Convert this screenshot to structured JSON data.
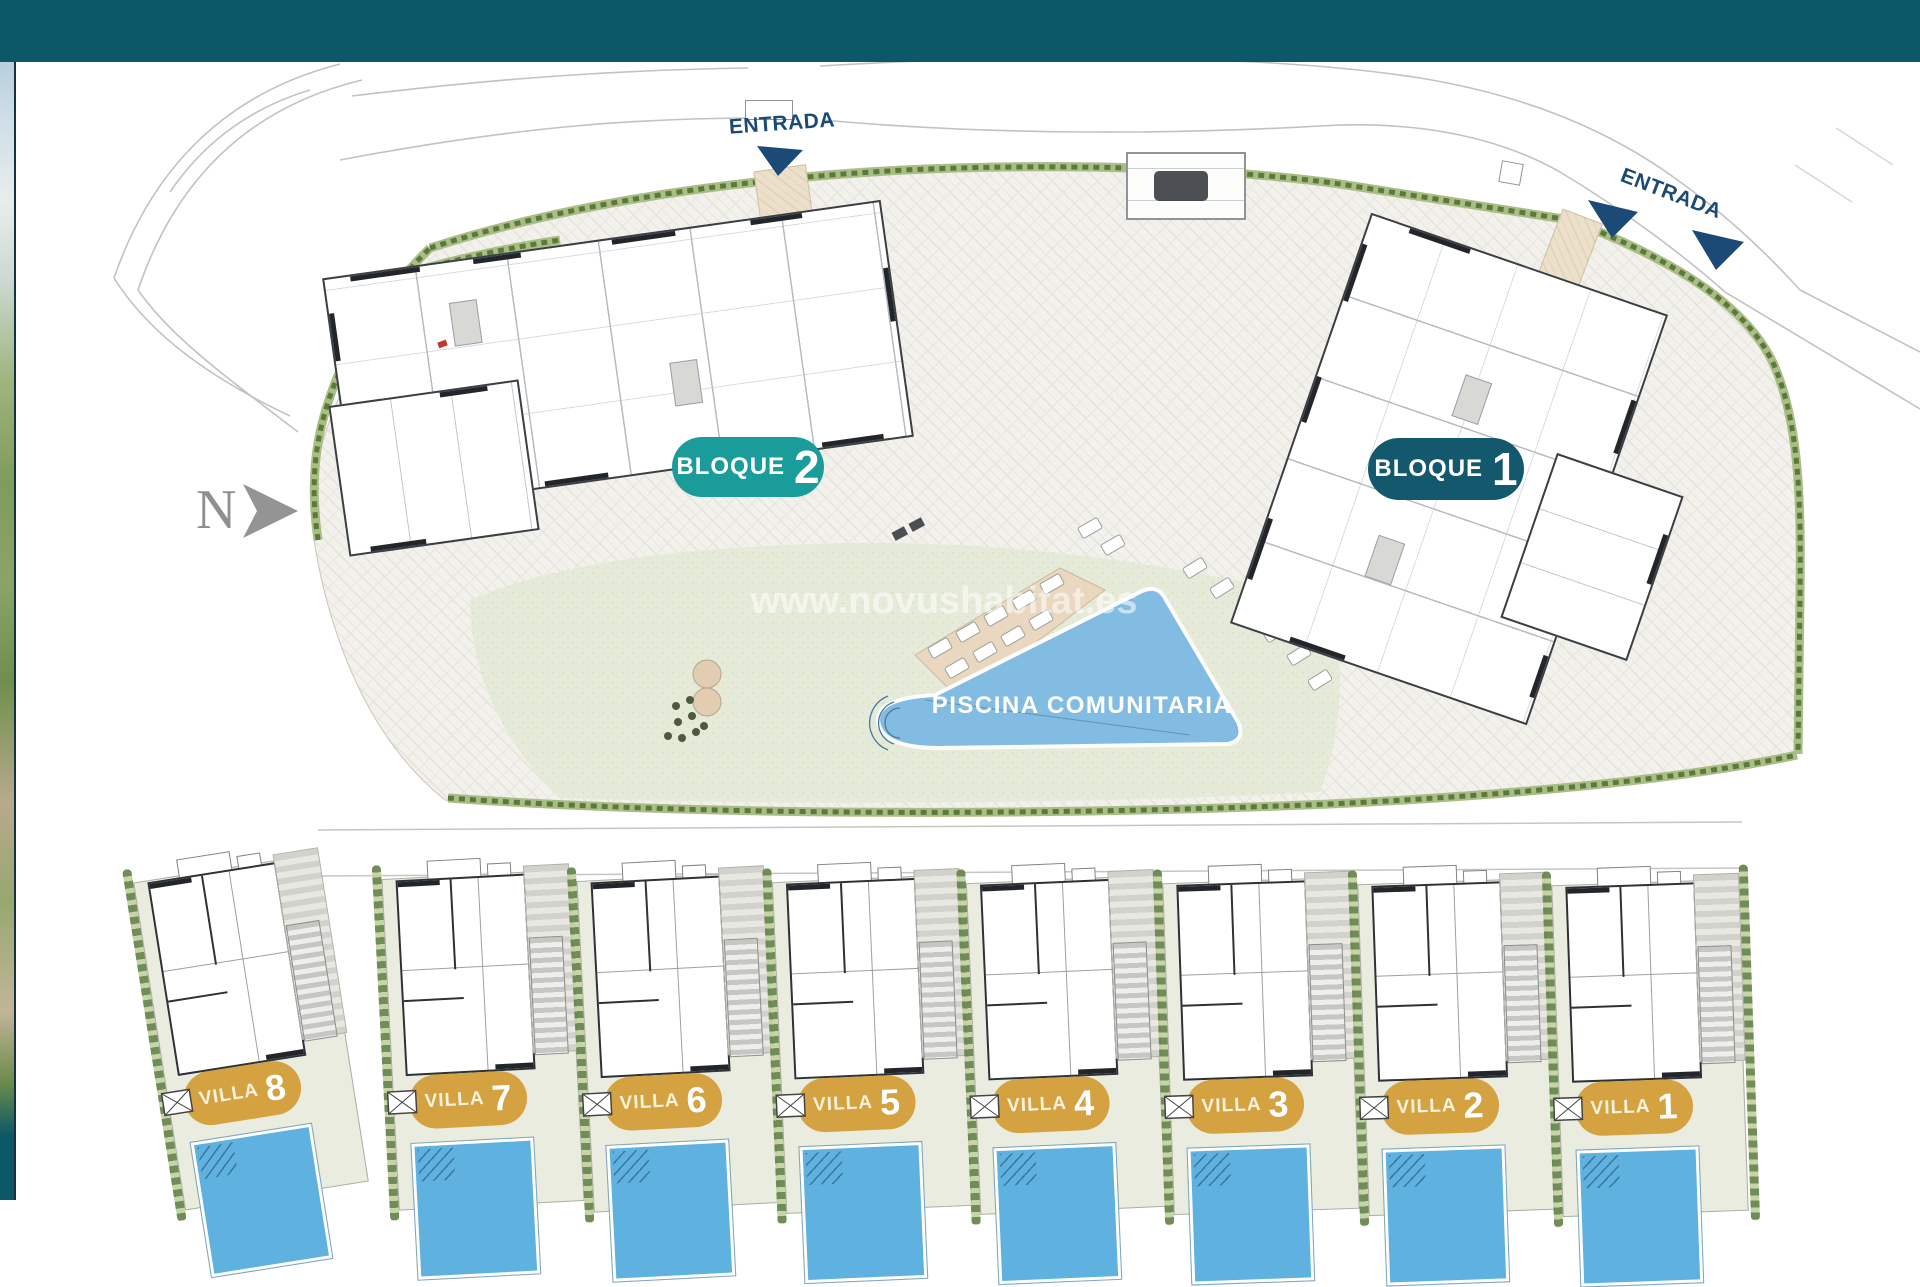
{
  "banner": {
    "color": "#0d5868"
  },
  "plan": {
    "north_label": "N",
    "entrance_top": {
      "label": "ENTRADA"
    },
    "entrance_right": {
      "label": "ENTRADA"
    },
    "watermark": "www.novushabitat.es",
    "bloques": [
      {
        "label": "BLOQUE",
        "number": "2",
        "pill_color": "#1a9d9a"
      },
      {
        "label": "BLOQUE",
        "number": "1",
        "pill_color": "#14586d"
      }
    ],
    "communal_pool": {
      "label": "PISCINA COMUNITARIA",
      "water_color": "#83bce3"
    },
    "villas": [
      {
        "label": "VILLA",
        "number": "8"
      },
      {
        "label": "VILLA",
        "number": "7"
      },
      {
        "label": "VILLA",
        "number": "6"
      },
      {
        "label": "VILLA",
        "number": "5"
      },
      {
        "label": "VILLA",
        "number": "4"
      },
      {
        "label": "VILLA",
        "number": "3"
      },
      {
        "label": "VILLA",
        "number": "2"
      },
      {
        "label": "VILLA",
        "number": "1"
      }
    ],
    "villa_pill_color": "#d4a240",
    "villa_pool_color": "#5fb2e0"
  }
}
